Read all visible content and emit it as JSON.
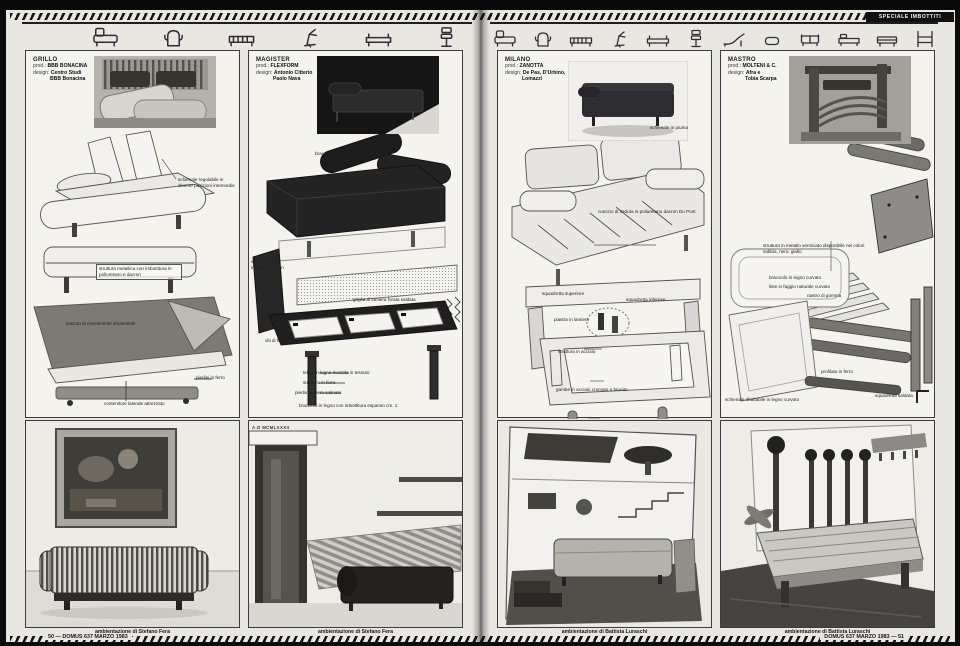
{
  "masthead": {
    "special_label": "SPECIALE IMBOTTITI"
  },
  "meta": {
    "prod_label": "prod.:",
    "design_label": "design:"
  },
  "icon_strip": {
    "left": [
      "sofa-bed",
      "wing-armchair",
      "slatted-daybed",
      "recliner-chair",
      "bench-seat",
      "office-chair"
    ],
    "right": [
      "sofa-bed",
      "wing-armchair",
      "slatted-daybed",
      "recliner-chair",
      "bench-seat",
      "office-chair",
      "chaise-longue",
      "pouf",
      "two-seater-sofa",
      "daybed",
      "convertible-sofa",
      "bed-frame"
    ]
  },
  "columns": [
    {
      "name": "GRILLO",
      "prod": "BBB BONACINA",
      "design1": "Centro Studi",
      "design2": "BBB Bonacina",
      "labels": [
        "schienale regolabile in diverse posizioni intermedie",
        "struttura metallica con imbottitura in poliuretano e dacron",
        "tessuto di rivestimento sfoderabile",
        "piedini in ferro",
        "contenitore laterale attrezzato"
      ],
      "caption": "ambientazione di Stefano Fera"
    },
    {
      "name": "MAGISTER",
      "prod": "FLEXFORM",
      "design1": "Antonio Citterio",
      "design2": "Paolo Nava",
      "labels": [
        "bracciolo rotondo imbottito in piuma",
        "schienale imbottito dacron",
        "griglia di lamiera forata saldata",
        "viti di fissaggio",
        "telaio in legno rivestito in tessuto",
        "struttura in ferro",
        "piedini in ferro satinato",
        "bracciolo in legno con imbottitura espanso cm. 1"
      ],
      "inscription": "A.D MCMLXXXII",
      "caption": "ambientazione di Stefano Fera"
    },
    {
      "name": "MILANO",
      "prod": "ZANOTTA",
      "design1": "De Pas, D'Urbino,",
      "design2": "Lomazzi",
      "labels": [
        "schienale in piuma",
        "cuscino di seduta in poliuretano dacron Du Pont",
        "squadretta superiore",
        "squadretta inferiore",
        "piastra in lamiera",
        "struttura in acciaio",
        "gambe in acciaio cromato o brunito"
      ],
      "caption": "ambientazione di Battista Luraschi"
    },
    {
      "name": "MASTRO",
      "prod": "MOLTENI & C.",
      "design1": "Afra e",
      "design2": "Tobia Scarpa",
      "labels": [
        "struttura in metallo verniciato disponibile nei colori sabbia, nero, giallo",
        "bracciolo in legno curvato",
        "liste in faggio naturale curvato",
        "nastro di gomma",
        "profilato in ferro",
        "squadretta saldata",
        "schienale ribaltabile in legno curvato"
      ],
      "caption": "ambientazione di Battista Luraschi"
    }
  ],
  "footer": {
    "left_page": "50 — DOMUS 637 MARZO 1983",
    "right_page": "DOMUS 637 MARZO 1983 — 51"
  },
  "colors": {
    "paper": "#e9e7e1",
    "ink": "#1c1c1c",
    "masthead_bg": "#101010"
  }
}
